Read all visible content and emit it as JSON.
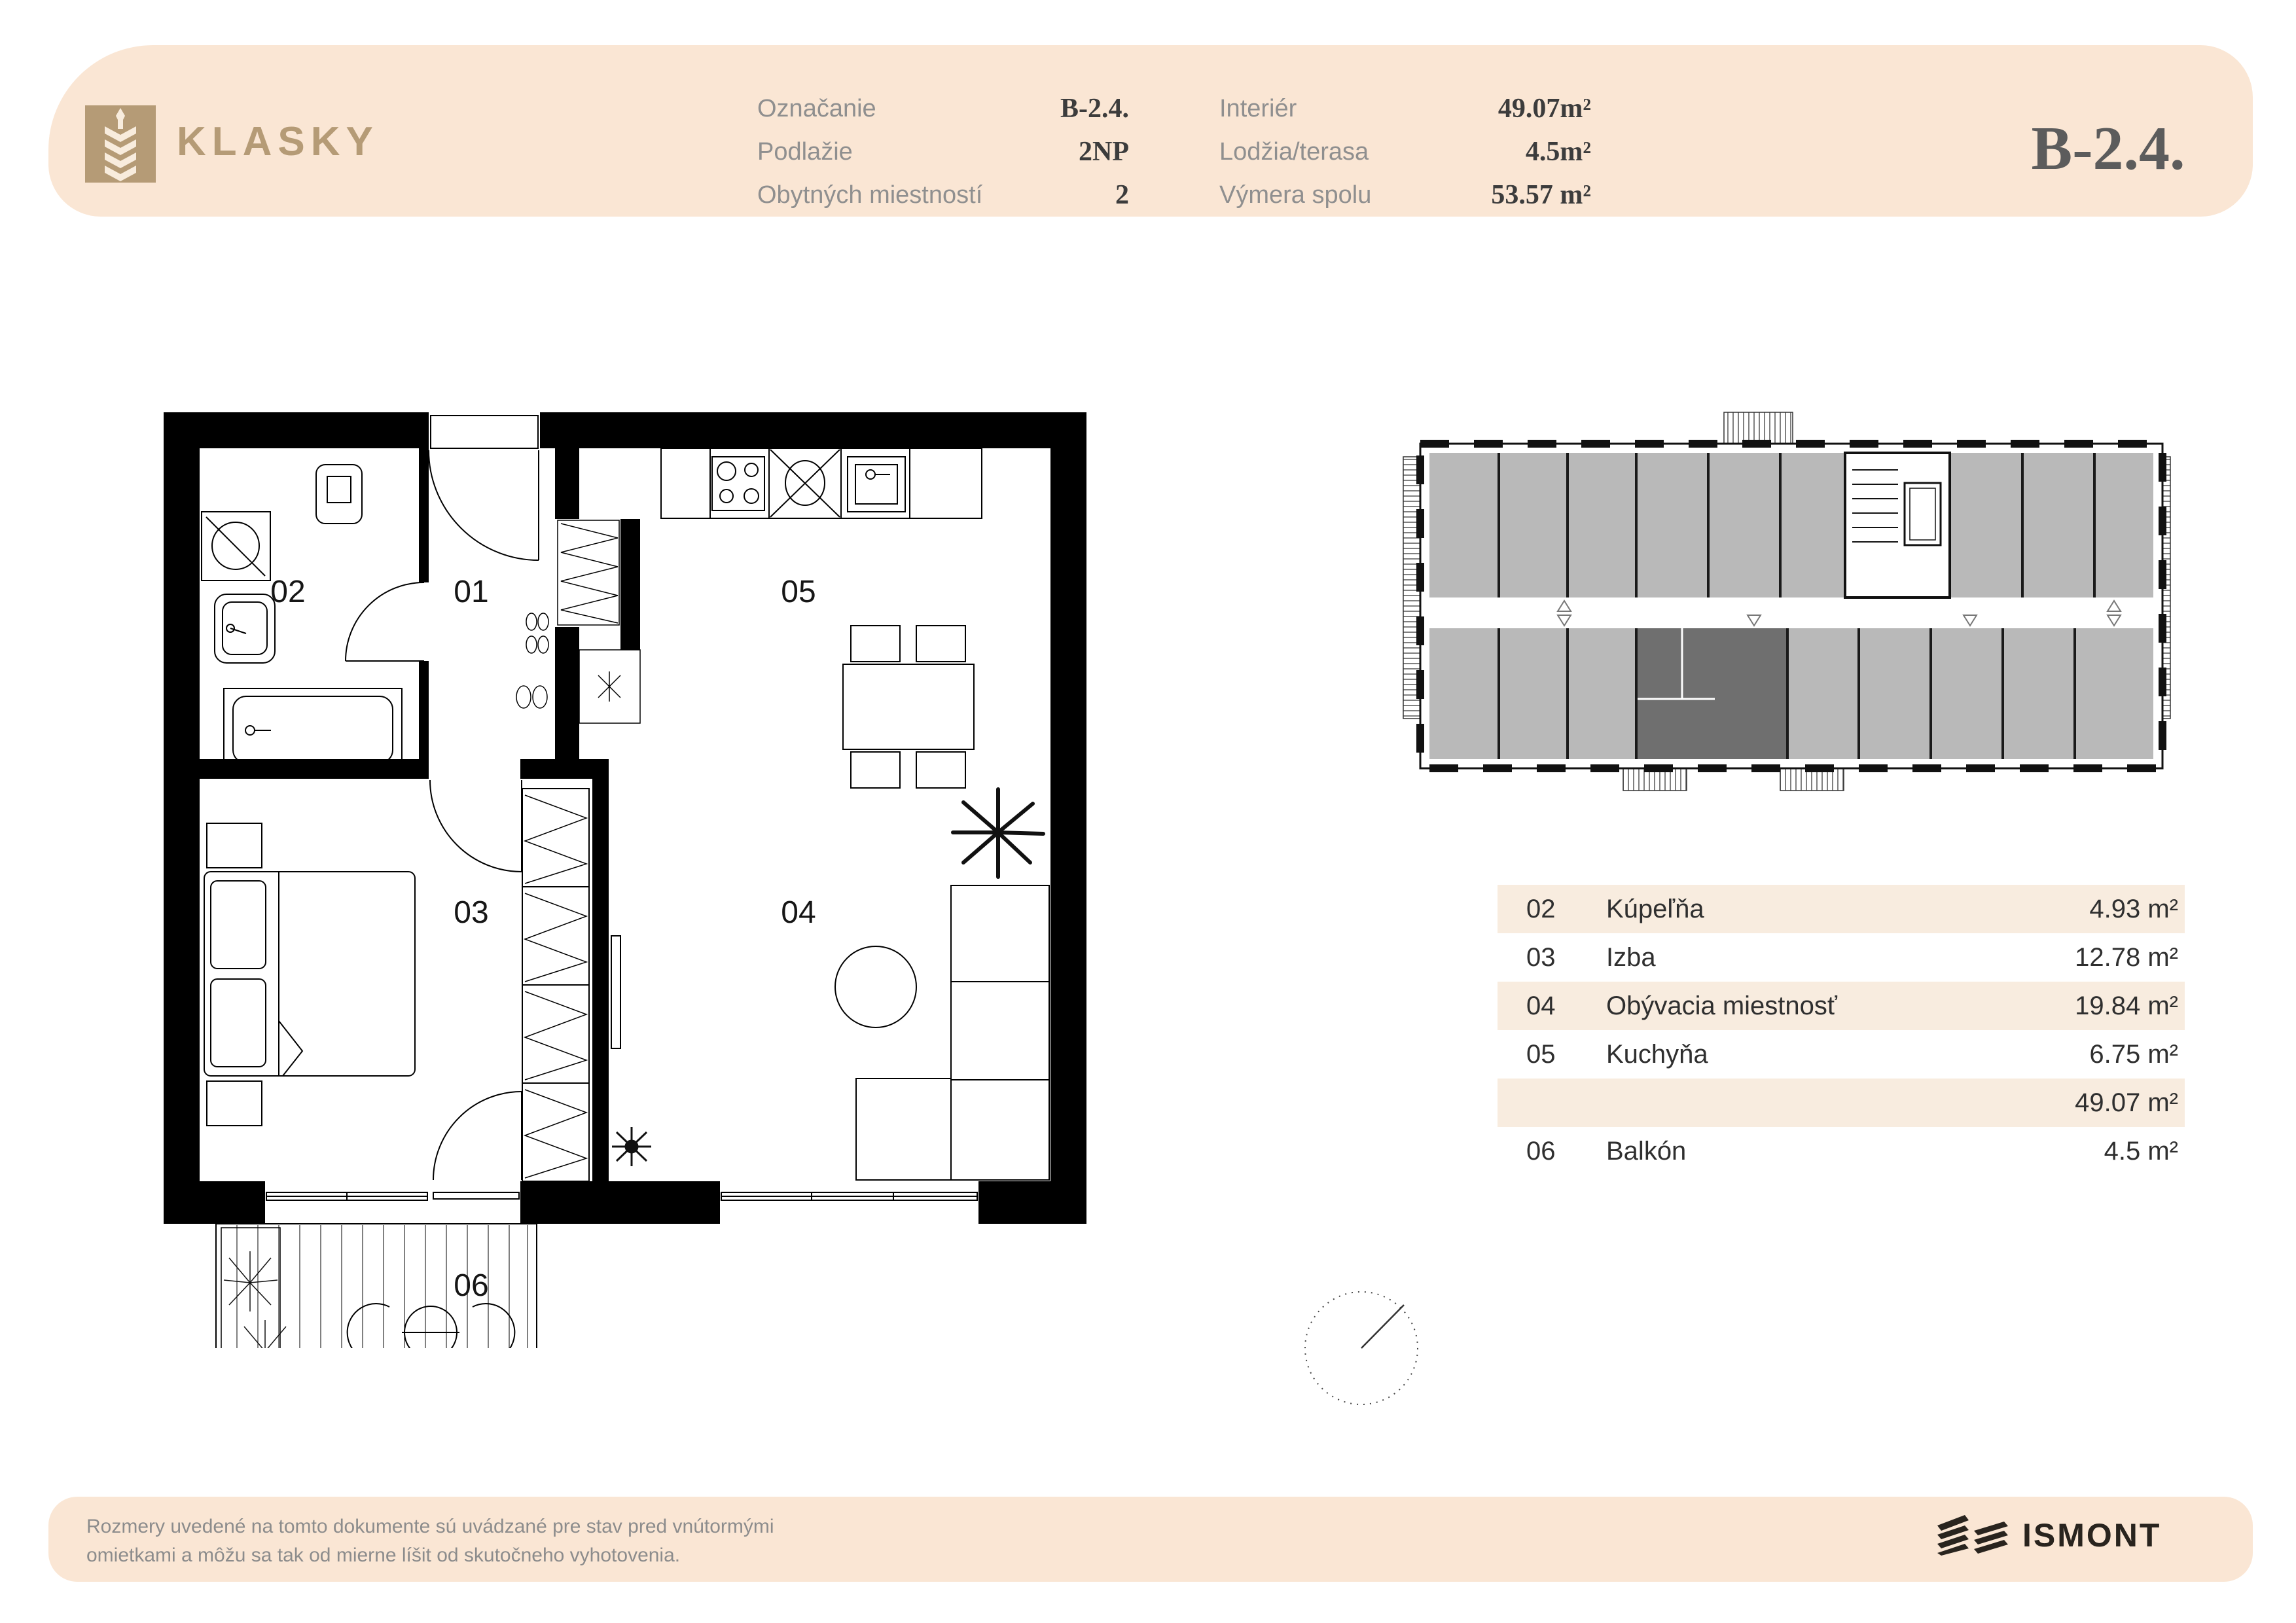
{
  "header": {
    "brand": "KLASKY",
    "unit_code": "B-2.4.",
    "fields_left": [
      {
        "label": "Označanie",
        "value": "B-2.4."
      },
      {
        "label": "Podlažie",
        "value": "2NP"
      },
      {
        "label": "Obytných miestností",
        "value": "2"
      }
    ],
    "fields_right": [
      {
        "label": "Interiér",
        "value": "49.07m²"
      },
      {
        "label": "Lodžia/terasa",
        "value": "4.5m²"
      },
      {
        "label": "Výmera spolu",
        "value": "53.57 m²"
      }
    ]
  },
  "floorplan": {
    "labels": {
      "r01": "01",
      "r02": "02",
      "r03": "03",
      "r04": "04",
      "r05": "05",
      "r06": "06"
    }
  },
  "table": {
    "rows": [
      {
        "num": "02",
        "name": "Kúpeľňa",
        "area": "4.93 m²"
      },
      {
        "num": "03",
        "name": "Izba",
        "area": "12.78 m²"
      },
      {
        "num": "04",
        "name": "Obývacia miestnosť",
        "area": "19.84 m²"
      },
      {
        "num": "05",
        "name": "Kuchyňa",
        "area": "6.75 m²"
      },
      {
        "num": "",
        "name": "",
        "area": "49.07 m²"
      },
      {
        "num": "06",
        "name": "Balkón",
        "area": "4.5 m²"
      }
    ]
  },
  "footer": {
    "disclaimer_line1": "Rozmery uvedené na tomto dokumente sú uvádzané pre stav pred vnútormými",
    "disclaimer_line2": "omietkami a môžu sa tak od mierne líšit od skutočneho vyhotovenia.",
    "logo_text": "ISMONT"
  },
  "colors": {
    "band_beige": "#fae6d4",
    "table_row_beige": "#f8ecdf",
    "brand_tan": "#b59b76",
    "label_gray": "#8f8f8f",
    "value_dark": "#3c3c3c",
    "unit_code_gray": "#5c5c5c",
    "plan_line": "#000000",
    "overview_unit_gray": "#b9b9b9",
    "overview_highlight": "#6f6f6f",
    "ismont_dark": "#29241e"
  }
}
